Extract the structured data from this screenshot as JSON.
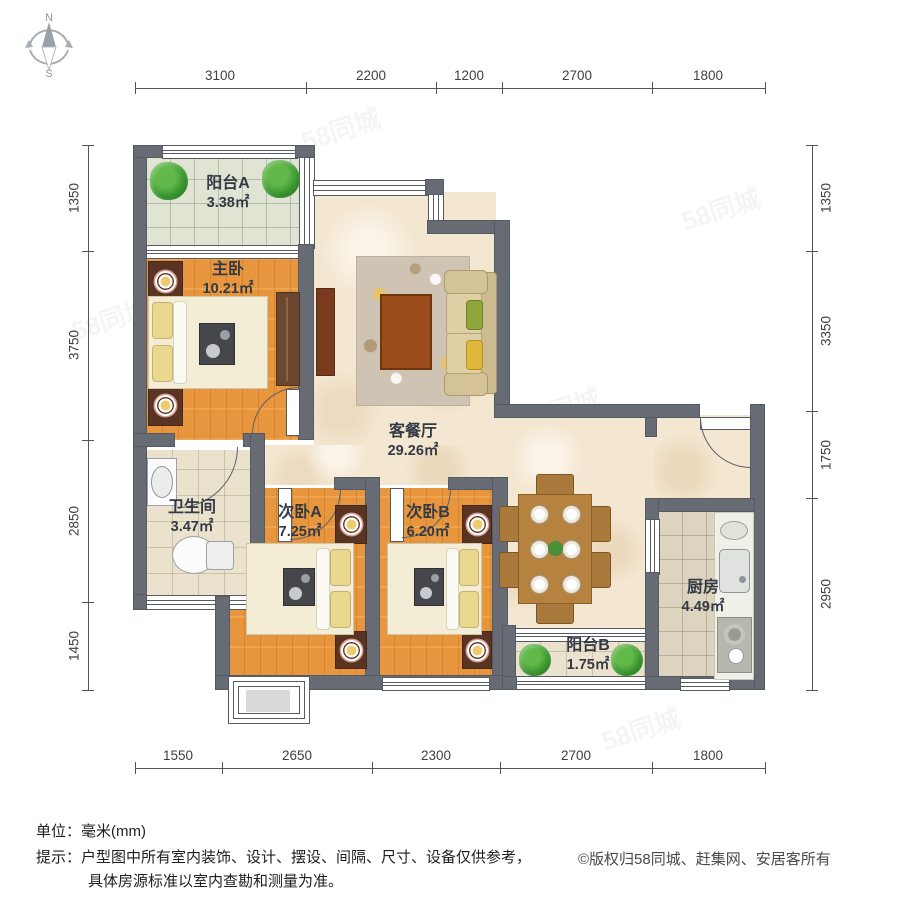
{
  "compass": {
    "north": "N",
    "south": "S"
  },
  "rooms": [
    {
      "id": "balcony_a",
      "name": "阳台A",
      "area": "3.38㎡"
    },
    {
      "id": "master",
      "name": "主卧",
      "area": "10.21㎡"
    },
    {
      "id": "living",
      "name": "客餐厅",
      "area": "29.26㎡"
    },
    {
      "id": "bathroom",
      "name": "卫生间",
      "area": "3.47㎡"
    },
    {
      "id": "bedroom_a",
      "name": "次卧A",
      "area": "7.25㎡"
    },
    {
      "id": "bedroom_b",
      "name": "次卧B",
      "area": "6.20㎡"
    },
    {
      "id": "balcony_b",
      "name": "阳台B",
      "area": "1.75㎡"
    },
    {
      "id": "kitchen",
      "name": "厨房",
      "area": "4.49㎡"
    }
  ],
  "dimensions": {
    "unit": "mm",
    "top": [
      "3100",
      "2200",
      "1200",
      "2700",
      "1800"
    ],
    "bottom": [
      "1550",
      "2650",
      "2300",
      "2700",
      "1800"
    ],
    "left": [
      "1350",
      "3750",
      "2850",
      "1450"
    ],
    "right": [
      "1350",
      "3350",
      "1750",
      "2950"
    ]
  },
  "footer": {
    "unit_label": "单位：",
    "unit_value": "毫米(mm)",
    "tip_label": "提示：",
    "tip_line1": "户型图中所有室内装饰、设计、摆设、间隔、尺寸、设备仅供参考，",
    "tip_line2": "具体房源标准以室内查勘和测量为准。",
    "copyright": "©版权归58同城、赶集网、安居客所有"
  },
  "watermark": "58同城",
  "colors": {
    "wall": "#676b74",
    "wood_floor": "#e8963e",
    "marble_floor": "#f4e7d1",
    "label_text": "#333a45"
  }
}
